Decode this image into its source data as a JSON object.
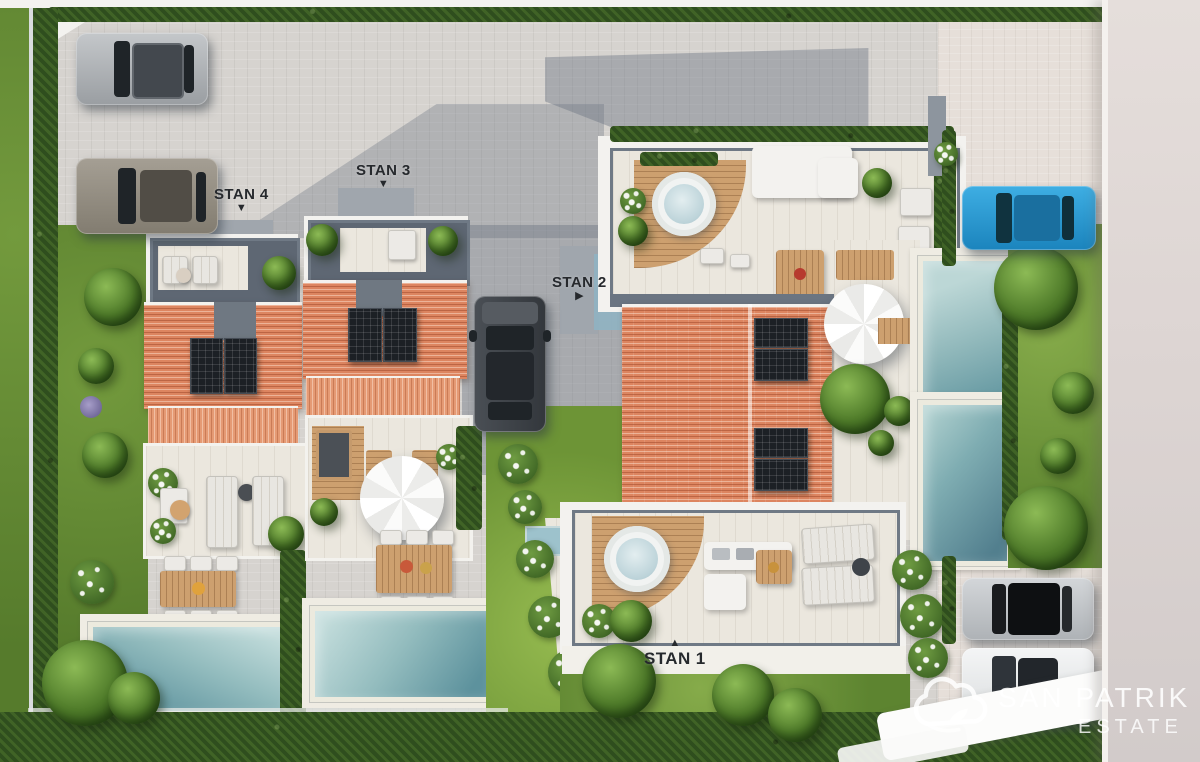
{
  "scene": {
    "description": "Aerial 3D render of a residential complex with four labeled units, pools, gardens and parked cars",
    "labels": [
      {
        "id": "stan1",
        "text": "STAN 1",
        "marker": "▲"
      },
      {
        "id": "stan2",
        "text": "STAN 2",
        "marker": "▶"
      },
      {
        "id": "stan3",
        "text": "STAN 3",
        "marker": "▼"
      },
      {
        "id": "stan4",
        "text": "STAN 4",
        "marker": "▼"
      }
    ],
    "watermark": {
      "brand": "SAN PATRIK",
      "tagline": "ESTATE"
    },
    "inventory": {
      "cars": [
        {
          "color": "silver",
          "location": "top-left parking"
        },
        {
          "color": "gray-bronze",
          "location": "left parking"
        },
        {
          "color": "dark-gray",
          "location": "center driveway"
        },
        {
          "color": "blue",
          "location": "top-right parking"
        },
        {
          "color": "silver-black-roof",
          "location": "bottom-right parking"
        },
        {
          "color": "white",
          "location": "bottom-right parking"
        }
      ],
      "rectangular_pools": 4,
      "hot_tubs": 2,
      "parasols": 2,
      "solar_panel_roofs": 3
    },
    "colors": {
      "roof_tile": "#dd8560",
      "pool_water": "#8fb8bd",
      "grass": "#749c3d",
      "hedge": "#2f4e1e",
      "pavement": "#d6d3cf",
      "label_text": "#26292d",
      "blue_car": "#2ba0dc"
    }
  }
}
